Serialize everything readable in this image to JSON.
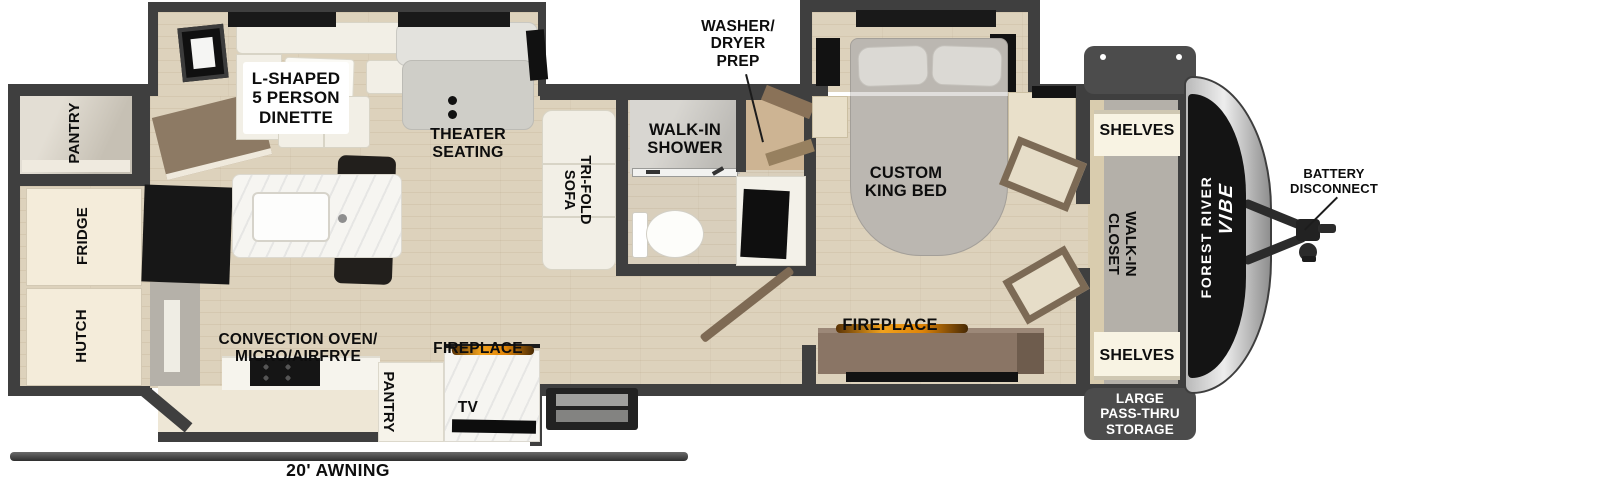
{
  "plan": {
    "title": "Travel trailer floor plan",
    "colors": {
      "wall": "#3f3f3f",
      "floor": "#ddd2bc",
      "flame": "#f2a21c",
      "storage_box": "#4c4c4c",
      "label": "#0d0d0d"
    },
    "rear": {
      "pantry": "PANTRY",
      "fridge": "FRIDGE",
      "hutch": "HUTCH"
    },
    "living": {
      "dinette": "L-SHAPED\n5 PERSON\nDINETTE",
      "theater_seating": "THEATER\nSEATING",
      "tri_fold_sofa": "TRI-FOLD\nSOFA",
      "convection_oven": "CONVECTION OVEN/\nMICRO/AIRFRYE",
      "pantry": "PANTRY",
      "fireplace": "FIREPLACE",
      "tv": "TV"
    },
    "bath": {
      "walk_in_shower": "WALK-IN\nSHOWER",
      "washer_dryer_prep": "WASHER/\nDRYER\nPREP"
    },
    "bedroom": {
      "custom_king_bed": "CUSTOM\nKING BED",
      "fireplace": "FIREPLACE"
    },
    "front": {
      "shelves_top": "SHELVES",
      "walk_in_closet": "WALK-IN\nCLOSET",
      "shelves_bottom": "SHELVES",
      "pass_thru_storage": "LARGE\nPASS-THRU\nSTORAGE"
    },
    "exterior": {
      "battery_disconnect": "BATTERY\nDISCONNECT",
      "awning": "20' AWNING",
      "brand_line1": "FOREST RIVER",
      "brand_line2": "VIBE"
    }
  }
}
